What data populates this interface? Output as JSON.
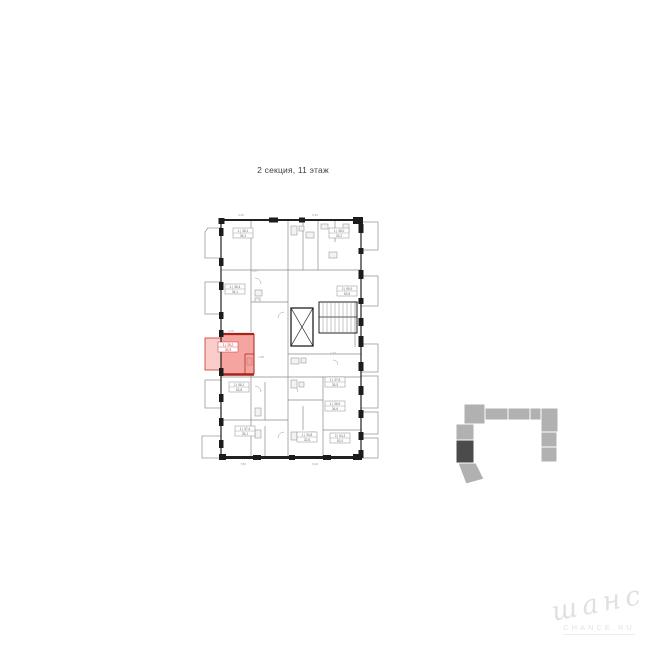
{
  "page": {
    "background": "#ffffff"
  },
  "title": {
    "text": "2 секция, 11 этаж"
  },
  "floorplan": {
    "wall_color": "#212121",
    "partition_color": "#8a8a8a",
    "highlight_color": "#c8322b",
    "highlight_wall_color": "#a8231d",
    "highlight_fill": "rgba(238,90,80,0.55)",
    "highlight_balcony_fill": "rgba(238,90,80,0.30)",
    "highlighted_unit": {
      "plate_rows": [
        "1 | 35,2",
        "33,9"
      ]
    },
    "unit_plates": [
      {
        "x": 230,
        "y": 226,
        "rows": [
          "1 | 38,1",
          "36,3"
        ],
        "red": false
      },
      {
        "x": 326,
        "y": 226,
        "rows": [
          "1 | 35,0",
          "33,2"
        ],
        "red": false
      },
      {
        "x": 222,
        "y": 282,
        "rows": [
          "1 | 36,4",
          "34,1"
        ],
        "red": false
      },
      {
        "x": 334,
        "y": 284,
        "rows": [
          "2 | 55,9",
          "53,6"
        ],
        "red": false
      },
      {
        "x": 215,
        "y": 340,
        "rows": [
          "1 | 35,2",
          "33,9"
        ],
        "red": true
      },
      {
        "x": 322,
        "y": 375,
        "rows": [
          "1 | 37,8",
          "35,5"
        ],
        "red": false
      },
      {
        "x": 322,
        "y": 399,
        "rows": [
          "1 | 36,9",
          "34,6"
        ],
        "red": false
      },
      {
        "x": 327,
        "y": 431,
        "rows": [
          "2 | 54,3",
          "52,0"
        ],
        "red": false
      },
      {
        "x": 226,
        "y": 380,
        "rows": [
          "2 | 56,2",
          "53,8"
        ],
        "red": false
      },
      {
        "x": 232,
        "y": 424,
        "rows": [
          "1 | 37,4",
          "35,1"
        ],
        "red": false
      },
      {
        "x": 294,
        "y": 430,
        "rows": [
          "1 | 34,8",
          "32,6"
        ],
        "red": false
      }
    ],
    "dimension_labels": [
      {
        "x": 238,
        "y": 214,
        "text": "6,48"
      },
      {
        "x": 312,
        "y": 214,
        "text": "5,32"
      },
      {
        "x": 228,
        "y": 330,
        "text": "3,75"
      },
      {
        "x": 258,
        "y": 356,
        "text": "1,98"
      },
      {
        "x": 240,
        "y": 463,
        "text": "7,80"
      },
      {
        "x": 312,
        "y": 463,
        "text": "6,90"
      },
      {
        "x": 330,
        "y": 352,
        "text": "1,77"
      },
      {
        "x": 252,
        "y": 270,
        "text": "2,07"
      }
    ]
  },
  "minimap": {
    "light_color": "#b1b1b1",
    "dark_color": "#4b4b4b",
    "seam_color": "#ffffff",
    "selected_section": "2"
  },
  "watermark": {
    "script": "шанс",
    "caption": "CHANCE.RU"
  }
}
